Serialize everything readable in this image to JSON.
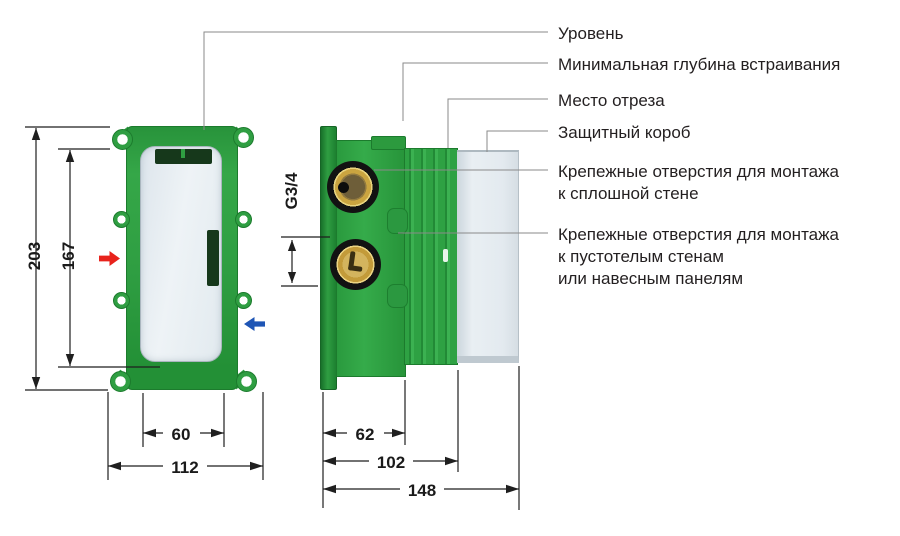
{
  "callouts": [
    {
      "lines": [
        "Уровень"
      ]
    },
    {
      "lines": [
        "Минимальная глубина встраивания"
      ]
    },
    {
      "lines": [
        "Место отреза"
      ]
    },
    {
      "lines": [
        "Защитный короб"
      ]
    },
    {
      "lines": [
        "Крепежные отверстия для монтажа",
        "к сплошной стене"
      ]
    },
    {
      "lines": [
        "Крепежные отверстия для монтажа",
        "к пустотелым стенам",
        "или навесным панелям"
      ]
    }
  ],
  "dimensions": {
    "front": {
      "outer_height": "203",
      "inner_height": "167",
      "inner_width": "60",
      "outer_width": "112"
    },
    "side": {
      "thread_size": "G3/4",
      "body_depth": "62",
      "cut_depth": "102",
      "total_depth": "148"
    }
  },
  "colors": {
    "body_green": "#2f9e42",
    "dark_slot_green": "#16381b",
    "brass": "#c9a43f",
    "protective_box_gray": "#e3eaef",
    "hot_arrow_red": "#e8231c",
    "cold_arrow_blue": "#1e55b5",
    "line_black": "#1a1a1a",
    "leader_gray": "#8a8a8a"
  }
}
